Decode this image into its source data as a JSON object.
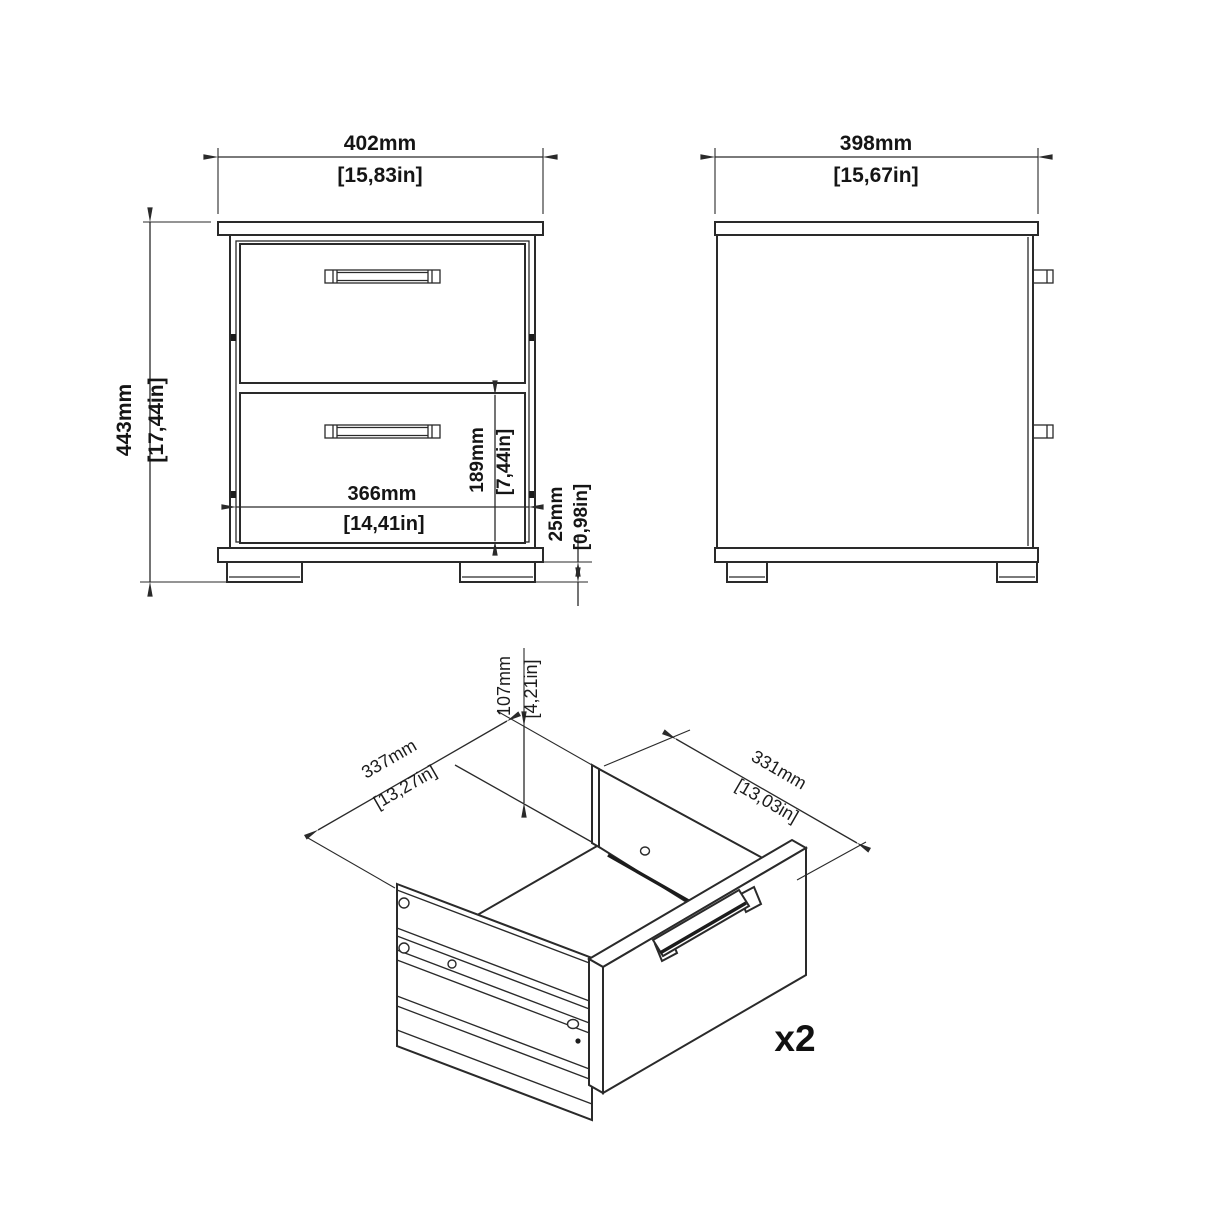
{
  "drawing": {
    "front_view": {
      "width_mm": "402mm",
      "width_in": "[15,83in]",
      "height_mm": "443mm",
      "height_in": "[17,44in]",
      "drawer_width_mm": "366mm",
      "drawer_width_in": "[14,41in]",
      "drawer_height_mm": "189mm",
      "drawer_height_in": "[7,44in]",
      "foot_height_mm": "25mm",
      "foot_height_in": "[0,98in]"
    },
    "side_view": {
      "depth_mm": "398mm",
      "depth_in": "[15,67in]"
    },
    "drawer_view": {
      "depth_mm": "337mm",
      "depth_in": "[13,27in]",
      "width_mm": "331mm",
      "width_in": "[13,03in]",
      "height_mm": "107mm",
      "height_in": "[4,21in]",
      "quantity": "x2"
    },
    "colors": {
      "line": "#2a2a2a",
      "background": "#ffffff"
    }
  }
}
